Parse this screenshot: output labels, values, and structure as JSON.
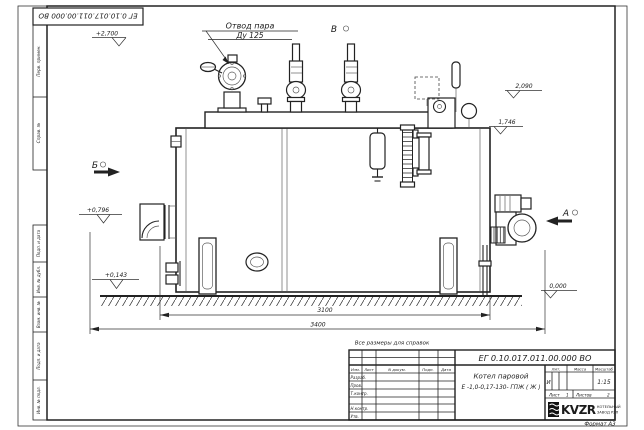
{
  "frame": {
    "top_designation": "ЕГ 0.10.017.011.00.000 ВО",
    "side_top": [
      "Перв. примен.",
      "Справ. №"
    ],
    "side_bottom": [
      "Подп. и дата",
      "Инв. № дубл.",
      "Взам. инв. №",
      "Подп. и дата",
      "Инв. № подл."
    ],
    "format_label": "Формат А3"
  },
  "drawing": {
    "callout_line1": "Отвод пара",
    "callout_line2": "Ду 125",
    "view_v": "В",
    "view_b": "Б",
    "view_a": "А",
    "elev_2700": "+2,700",
    "elev_2090": "2,090",
    "elev_1746": "1,746",
    "elev_0796": "+0,796",
    "elev_0143": "+0,143",
    "elev_0000": "0,000",
    "dim_inner": "3100",
    "dim_outer": "3400",
    "note": "Все размеры для справок"
  },
  "title_block": {
    "designation": "ЕГ 0.10.017.011.00.000  ВО",
    "name_line1": "Котел паровой",
    "name_line2": "Е -1,0-0,17-130- ГПЖ ( Ж )",
    "col_izm": "Изм.",
    "col_list": "Лист",
    "col_ndokum": "N докум.",
    "col_podp": "Подп.",
    "col_data": "Дата",
    "row_razrab": "Разраб.",
    "row_prov": "Пров.",
    "row_tkontr": "Т.контр.",
    "row_nkontr": "Н.контр.",
    "row_utv": "Утв.",
    "lit_header": "Лит.",
    "mass_header": "Масса",
    "scale_header": "Масштаб",
    "lit_value": "И",
    "scale_value": "1:15",
    "sheet_label": "Лист",
    "sheet_value": "1",
    "sheets_label": "Листов",
    "sheets_value": "2",
    "logo_text": "KVZR",
    "company_line1": "КОТЕЛЬНЫЙ",
    "company_line2": "ЗАВОД РЭП"
  }
}
